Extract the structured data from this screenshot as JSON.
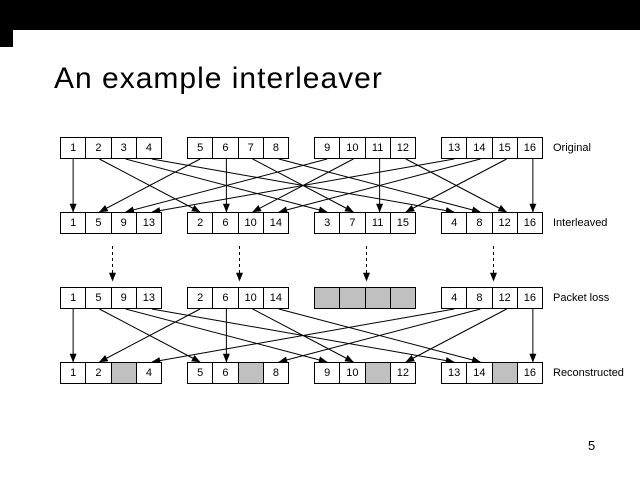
{
  "slide": {
    "title": "An example interleaver",
    "page_number": "5"
  },
  "diagram": {
    "arrow_color": "#000000",
    "lost_cell_color": "#c0c0c0",
    "rows": [
      {
        "label": "Original",
        "groups": [
          [
            "1",
            "2",
            "3",
            "4"
          ],
          [
            "5",
            "6",
            "7",
            "8"
          ],
          [
            "9",
            "10",
            "11",
            "12"
          ],
          [
            "13",
            "14",
            "15",
            "16"
          ]
        ]
      },
      {
        "label": "Interleaved",
        "groups": [
          [
            "1",
            "5",
            "9",
            "13"
          ],
          [
            "2",
            "6",
            "10",
            "14"
          ],
          [
            "3",
            "7",
            "11",
            "15"
          ],
          [
            "4",
            "8",
            "12",
            "16"
          ]
        ]
      },
      {
        "label": "Packet loss",
        "groups": [
          [
            "1",
            "5",
            "9",
            "13"
          ],
          [
            "2",
            "6",
            "10",
            "14"
          ],
          [
            "",
            "",
            "",
            ""
          ],
          [
            "4",
            "8",
            "12",
            "16"
          ]
        ]
      },
      {
        "label": "Reconstructed",
        "groups": [
          [
            "1",
            "2",
            "",
            "4"
          ],
          [
            "5",
            "6",
            "",
            "8"
          ],
          [
            "9",
            "10",
            "",
            "12"
          ],
          [
            "13",
            "14",
            "",
            "16"
          ]
        ]
      }
    ]
  }
}
